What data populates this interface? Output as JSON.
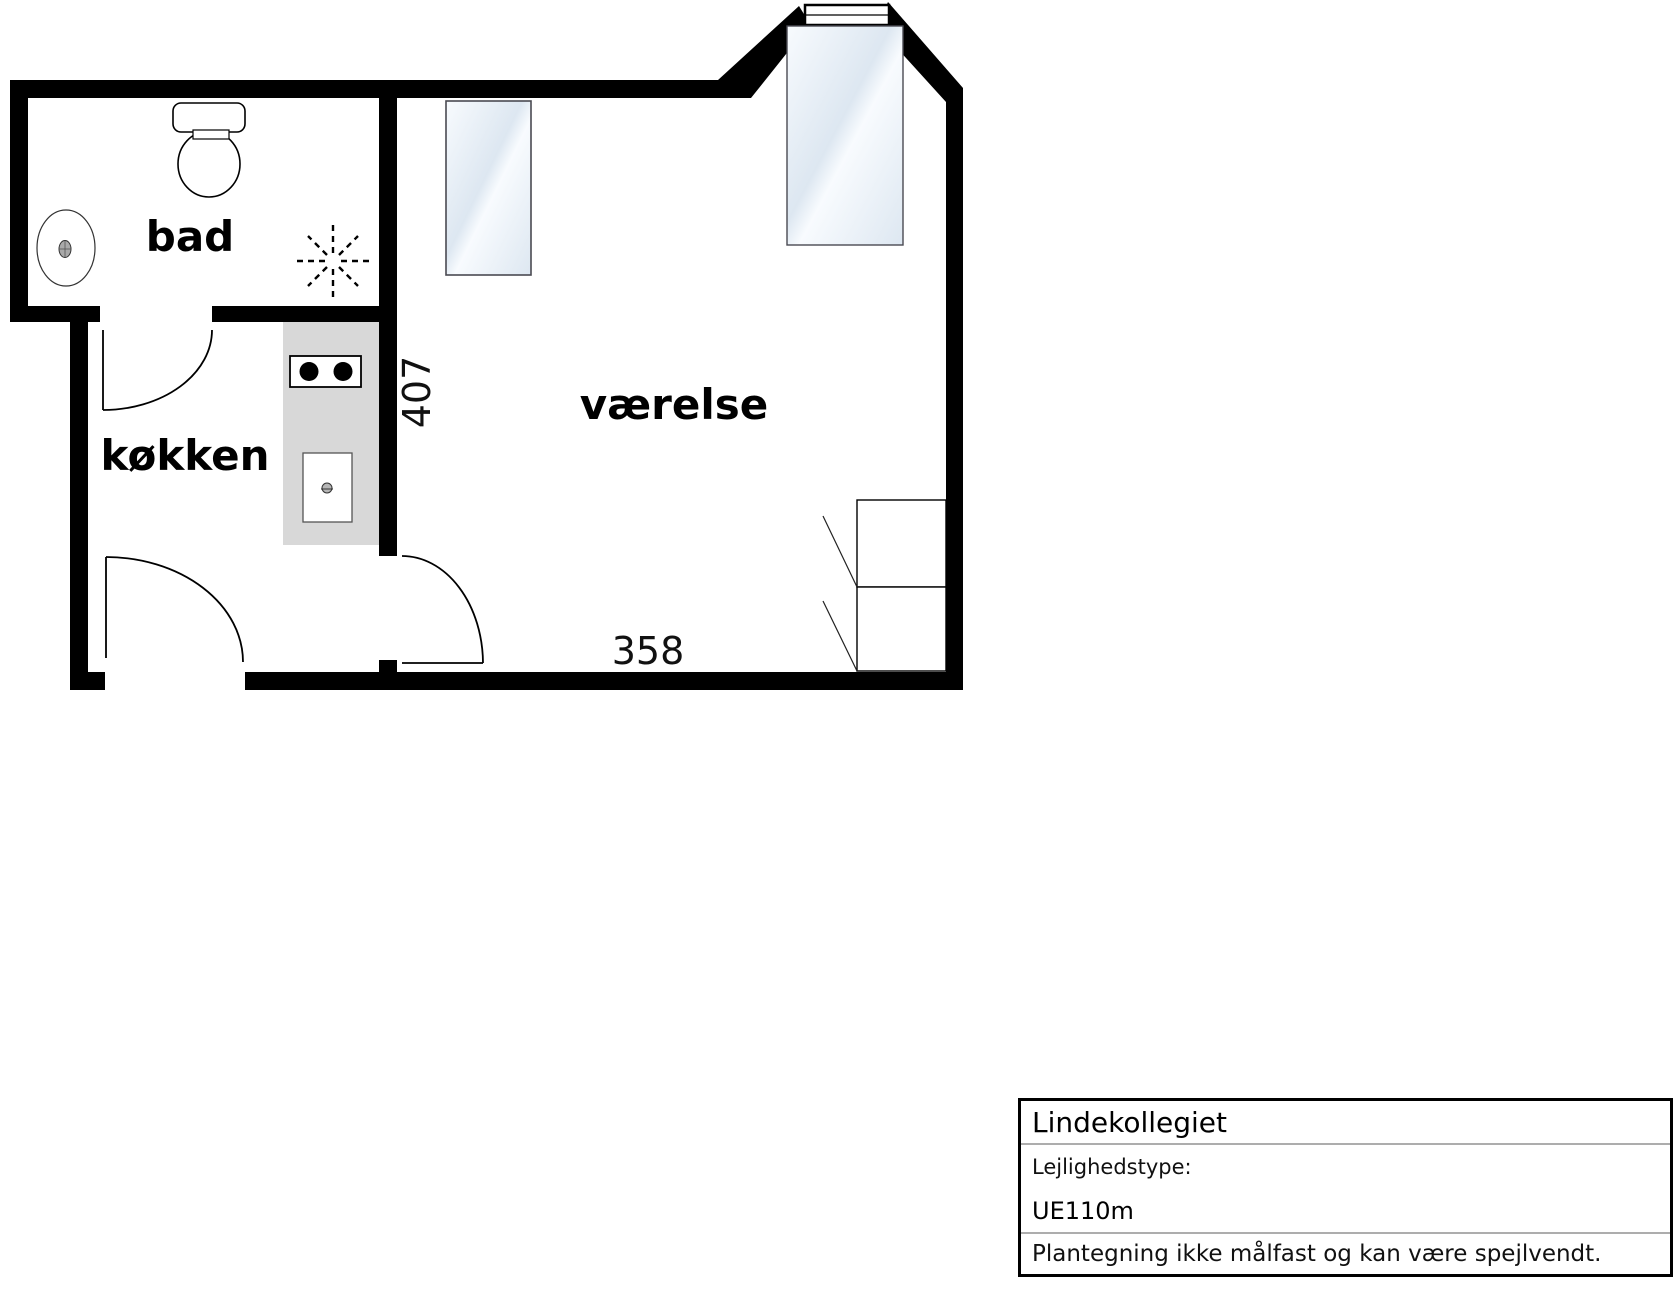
{
  "plan": {
    "room_labels": {
      "bathroom": "bad",
      "kitchen": "køkken",
      "bedroom": "værelse"
    },
    "dimensions": {
      "horizontal": "358",
      "vertical": "407"
    }
  },
  "title_block": {
    "building": "Lindekollegiet",
    "type_label": "Lejlighedstype:",
    "type_value": "UE110m",
    "disclaimer": "Plantegning ikke målfast og kan være spejlvendt."
  },
  "colors": {
    "wall": "#000000",
    "counter": "#d8d8d8",
    "glass_light": "#f8fbfe",
    "glass_dark": "#dde7f1",
    "divider_line": "#adadad"
  }
}
